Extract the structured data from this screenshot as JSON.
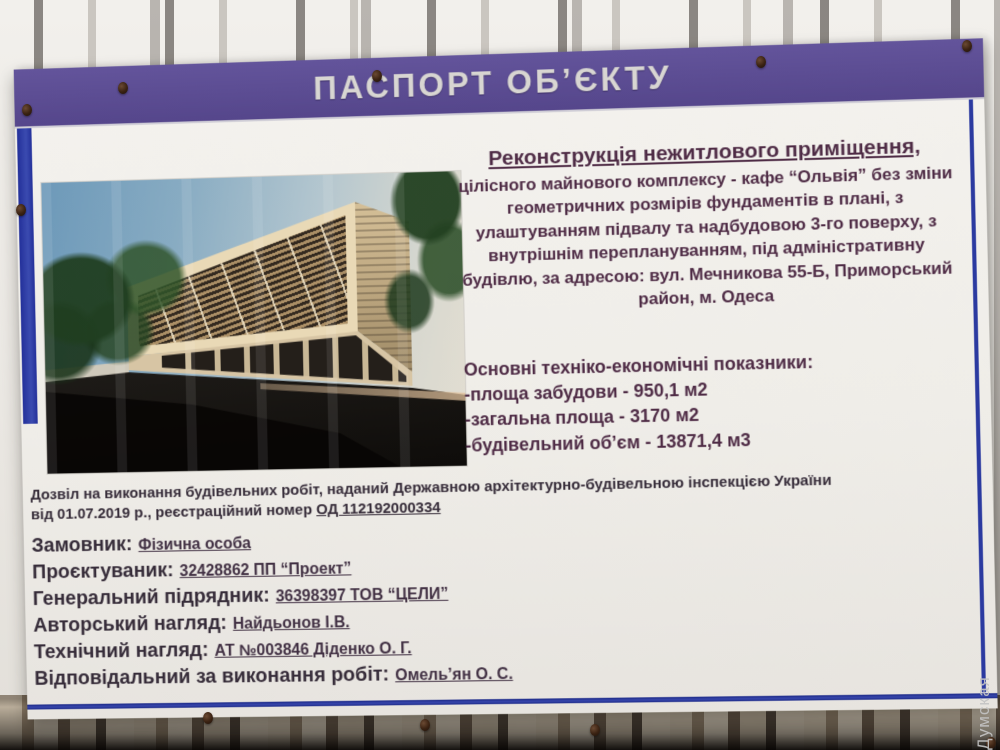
{
  "board": {
    "header": {
      "title": "ПАСПОРТ ОБ’ЄКТУ"
    },
    "project": {
      "title": "Реконструкція нежитлового приміщення,",
      "description": "цілісного майнового комплексу - кафе “Ольвія” без зміни геометричних розмірів фундаментів в плані, з улаштуванням підвалу та надбудовою 3-го поверху, з внутрішнім переплануванням, під адміністративну будівлю, за адресою: вул. Мечникова 55-Б, Приморський район, м. Одеса"
    },
    "indicators": {
      "heading": "Основні техніко-економічні показники:",
      "items": [
        "-площа забудови - 950,1 м2",
        "-загальна площа - 3170 м2",
        "-будівельний об’єм - 13871,4 м3"
      ]
    },
    "permit": {
      "line1": "Дозвіл на виконання будівельних робіт, наданий Державною архітектурно-будівельною інспекцією України",
      "line2_prefix": "від 01.07.2019 р., реєстраційний номер ",
      "number": "ОД 112192000334"
    },
    "parties": [
      {
        "label": "Замовник:",
        "value": "Фізична особа"
      },
      {
        "label": "Проєктуваник:",
        "value": "32428862 ПП “Проект”"
      },
      {
        "label": "Генеральний підрядник:",
        "value": "36398397 ТОВ “ЦЕЛИ”"
      },
      {
        "label": "Авторський нагляд:",
        "value": "Найдьонов І.В."
      },
      {
        "label": "Технічний нагляд:",
        "value": "АТ №003846 Діденко О. Г."
      },
      {
        "label": "Відповідальний за виконання робіт:",
        "value": "Омель’ян О. С."
      }
    ]
  },
  "watermark": "Думская",
  "colors": {
    "header_purple": "#63549b",
    "header_purple_dark": "#55468b",
    "frame_blue": "#2b3aa0",
    "text_plum": "#4e2b45",
    "text_dark": "#362c39"
  }
}
